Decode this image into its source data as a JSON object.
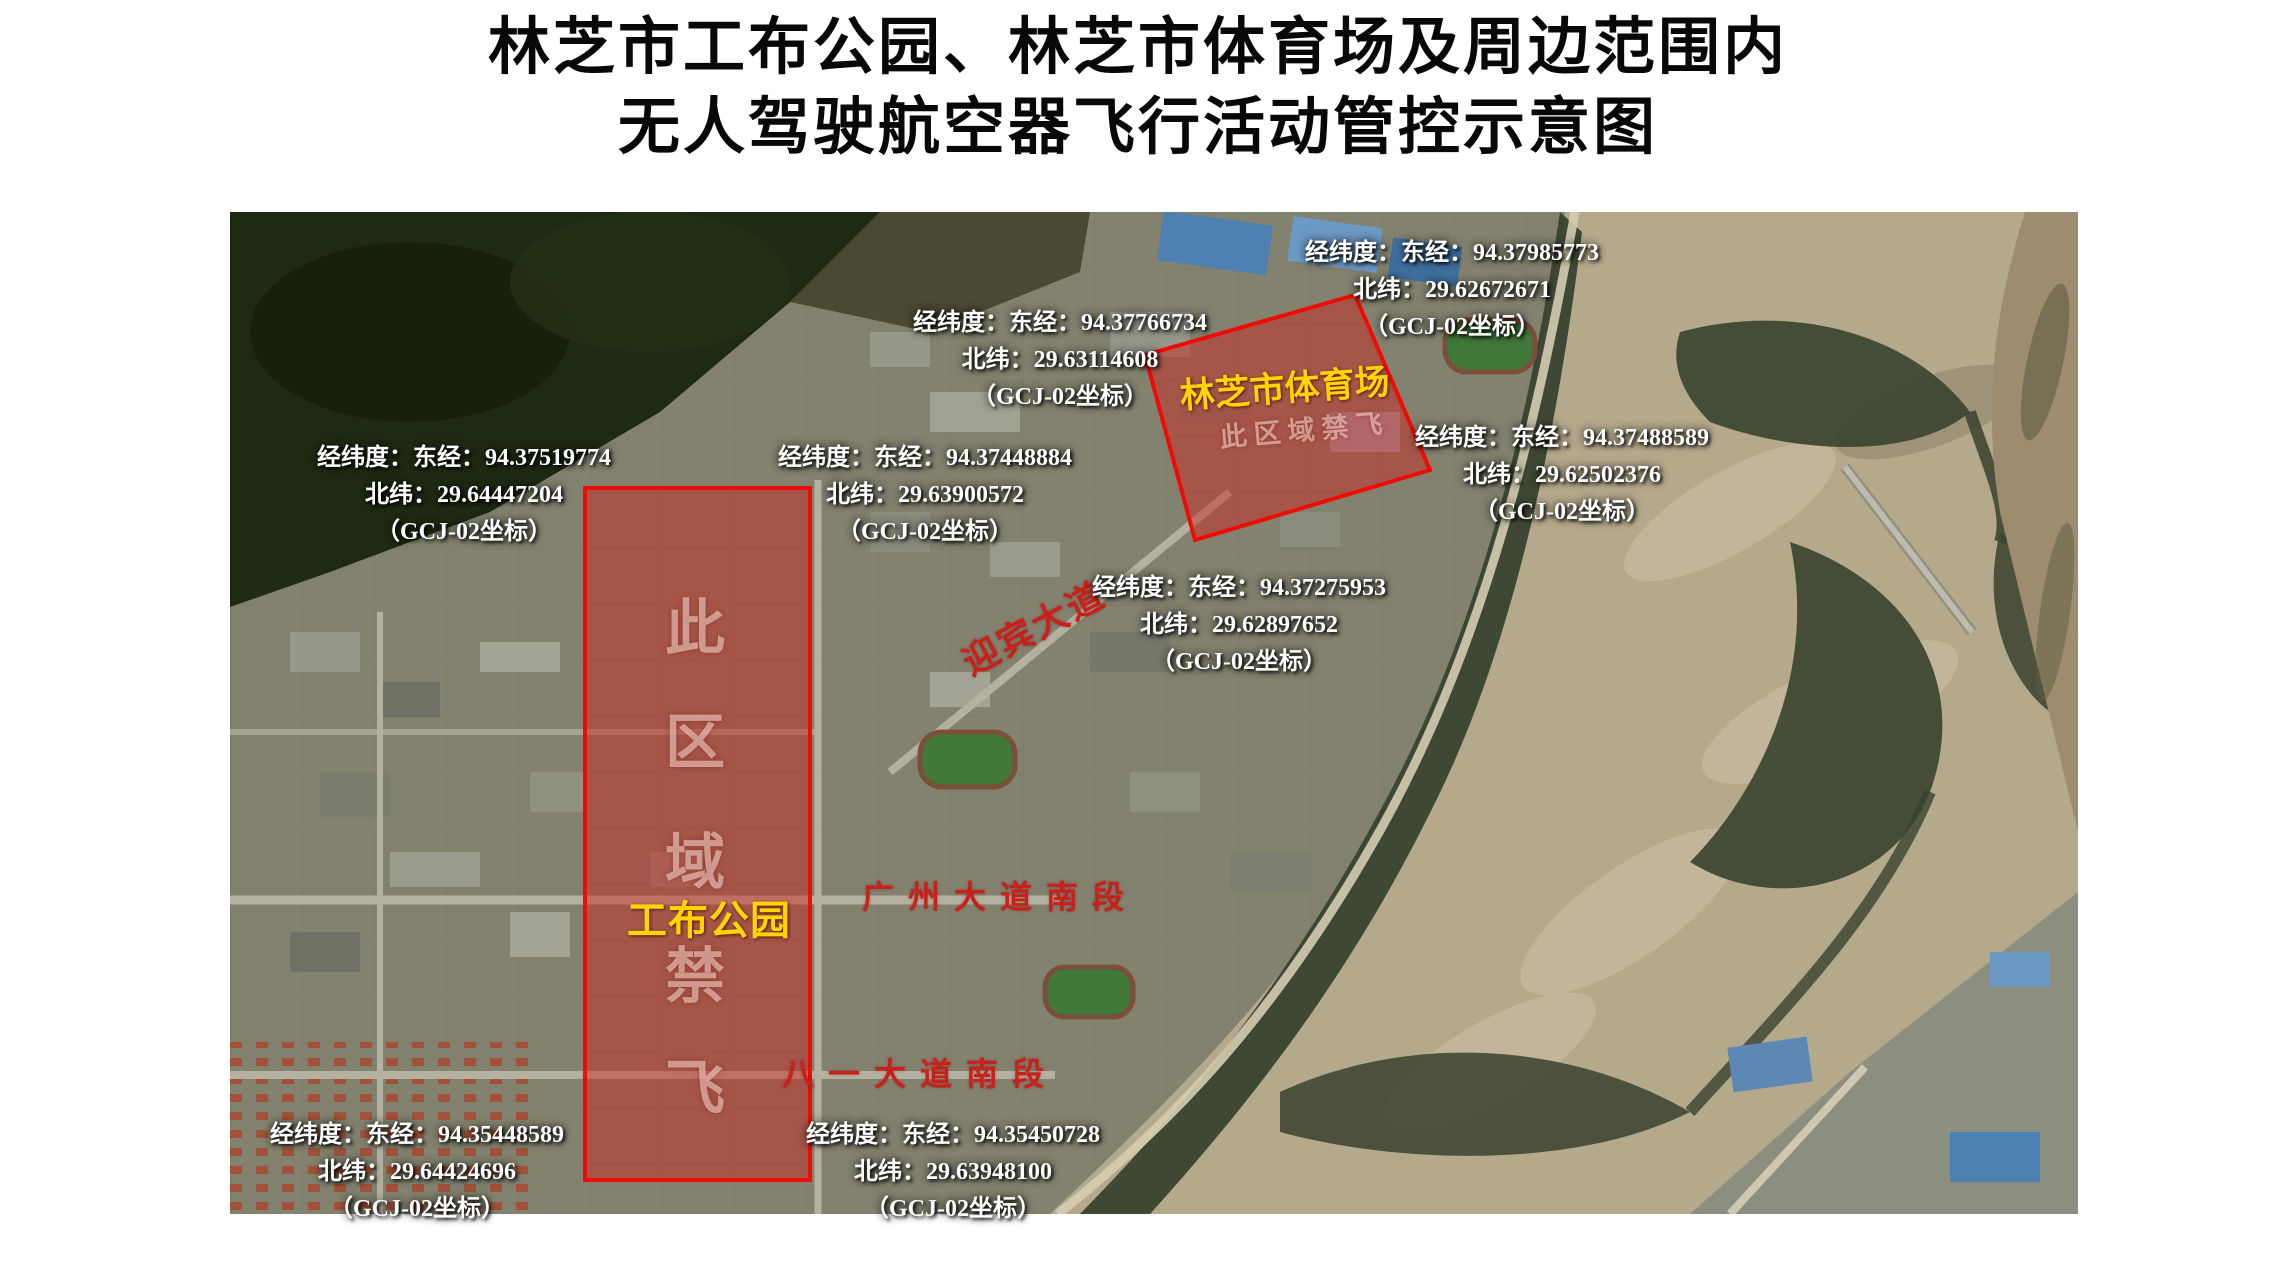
{
  "title": {
    "line1": "林芝市工布公园、林芝市体育场及周边范围内",
    "line2": "无人驾驶航空器飞行活动管控示意图"
  },
  "coordinate_labels": [
    {
      "line1": "经纬度：东经：94.37985773",
      "line2": "北纬：29.62672671",
      "line3": "（GCJ-02坐标）"
    },
    {
      "line1": "经纬度：东经：94.37766734",
      "line2": "北纬：29.63114608",
      "line3": "（GCJ-02坐标）"
    },
    {
      "line1": "经纬度：东经：94.37519774",
      "line2": "北纬：29.64447204",
      "line3": "（GCJ-02坐标）"
    },
    {
      "line1": "经纬度：东经：94.37448884",
      "line2": "北纬：29.63900572",
      "line3": "（GCJ-02坐标）"
    },
    {
      "line1": "经纬度：东经：94.37488589",
      "line2": "北纬：29.62502376",
      "line3": "（GCJ-02坐标）"
    },
    {
      "line1": "经纬度：东经：94.37275953",
      "line2": "北纬：29.62897652",
      "line3": "（GCJ-02坐标）"
    },
    {
      "line1": "经纬度：东经：94.35448589",
      "line2": "北纬：29.64424696",
      "line3": "（GCJ-02坐标）"
    },
    {
      "line1": "经纬度：东经：94.35450728",
      "line2": "北纬：29.63948100",
      "line3": "（GCJ-02坐标）"
    }
  ],
  "zones": {
    "park": {
      "name": "工布公园",
      "no_fly_chars": [
        "此",
        "区",
        "域",
        "禁",
        "飞"
      ]
    },
    "stadium": {
      "name": "林芝市体育场",
      "no_fly_text": "此区域禁飞"
    }
  },
  "street_labels": {
    "yingbin": "迎宾大道",
    "guangzhou": "广州大道南段",
    "bayi": "八一大道南段"
  },
  "colors": {
    "title_text": "#080808",
    "coordinate_text": "#ffffff",
    "zone_border": "#ef0b06",
    "zone_fill": "rgba(206,34,24,0.45)",
    "zone_name_text": "#ffd400",
    "no_fly_text": "rgba(255,226,217,0.55)",
    "street_text": "#c8211b"
  }
}
